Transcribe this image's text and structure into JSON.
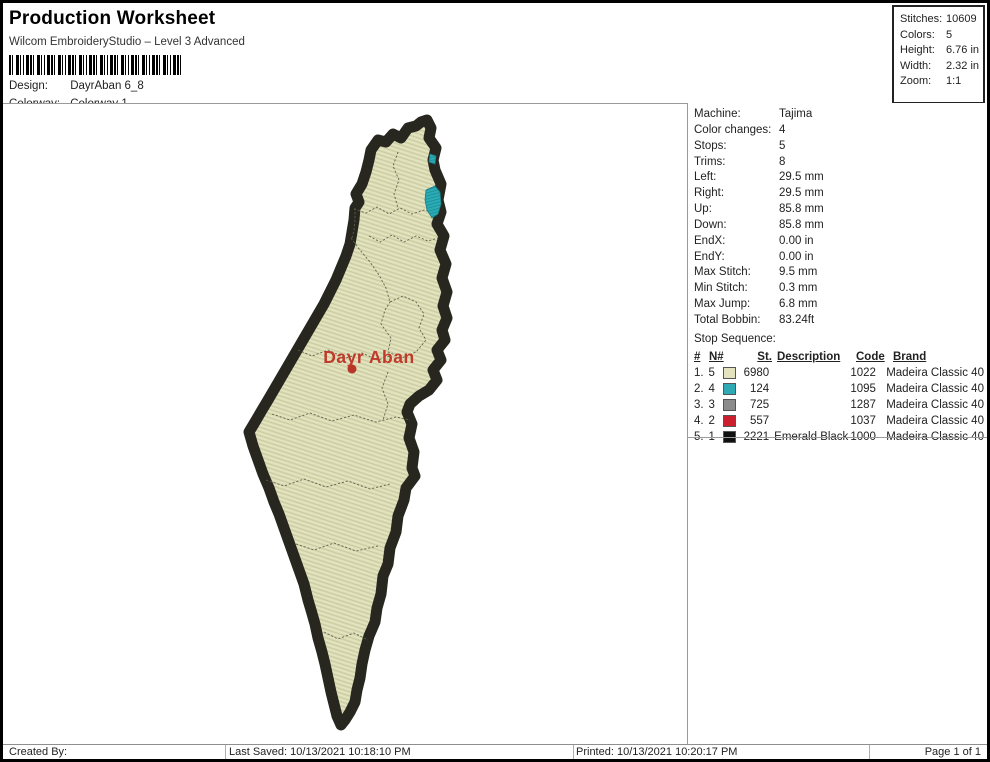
{
  "header": {
    "title": "Production Worksheet",
    "subtitle": "Wilcom EmbroideryStudio – Level 3 Advanced",
    "design_label": "Design:",
    "design_value": "DayrAban 6_8",
    "colorway_label": "Colorway:",
    "colorway_value": "Colorway 1"
  },
  "stats_box": {
    "rows": [
      {
        "label": "Stitches:",
        "value": "10609"
      },
      {
        "label": "Colors:",
        "value": "5"
      },
      {
        "label": "Height:",
        "value": "6.76 in"
      },
      {
        "label": "Width:",
        "value": "2.32 in"
      },
      {
        "label": "Zoom:",
        "value": "1:1"
      }
    ]
  },
  "info_panel": {
    "rows": [
      {
        "label": "Machine:",
        "value": "Tajima"
      },
      {
        "label": "Color changes:",
        "value": "4"
      },
      {
        "label": "Stops:",
        "value": "5"
      },
      {
        "label": "Trims:",
        "value": "8"
      },
      {
        "label": "Left:",
        "value": "29.5 mm"
      },
      {
        "label": "Right:",
        "value": "29.5 mm"
      },
      {
        "label": "Up:",
        "value": "85.8 mm"
      },
      {
        "label": "Down:",
        "value": "85.8 mm"
      },
      {
        "label": "EndX:",
        "value": "0.00 in"
      },
      {
        "label": "EndY:",
        "value": "0.00 in"
      },
      {
        "label": "Max Stitch:",
        "value": "9.5 mm"
      },
      {
        "label": "Min Stitch:",
        "value": "0.3 mm"
      },
      {
        "label": "Max Jump:",
        "value": "6.8 mm"
      },
      {
        "label": "Total Bobbin:",
        "value": "83.24ft"
      }
    ],
    "stop_sequence_label": "Stop Sequence:"
  },
  "stop_table": {
    "headers": {
      "num": "#",
      "n": "N#",
      "st": "St.",
      "description": "Description",
      "code": "Code",
      "brand": "Brand"
    },
    "rows": [
      {
        "num": "1.",
        "n": "5",
        "color": "#e3e3c0",
        "st": "6980",
        "description": "",
        "code": "1022",
        "brand": "Madeira Classic 40"
      },
      {
        "num": "2.",
        "n": "4",
        "color": "#2fa9b4",
        "st": "124",
        "description": "",
        "code": "1095",
        "brand": "Madeira Classic 40"
      },
      {
        "num": "3.",
        "n": "3",
        "color": "#8c8c8c",
        "st": "725",
        "description": "",
        "code": "1287",
        "brand": "Madeira Classic 40"
      },
      {
        "num": "4.",
        "n": "2",
        "color": "#cc1f2d",
        "st": "557",
        "description": "",
        "code": "1037",
        "brand": "Madeira Classic 40"
      },
      {
        "num": "5.",
        "n": "1",
        "color": "#101010",
        "st": "2221",
        "description": "Emerald Black",
        "code": "1000",
        "brand": "Madeira Classic 40"
      }
    ]
  },
  "design_preview": {
    "place_label": "Dayr Aban",
    "fill_color": "#dcddb5",
    "border_color": "#27271f",
    "lake_color": "#2aacb6",
    "label_color": "#c0392b"
  },
  "footer": {
    "created_by_label": "Created By:",
    "last_saved": "Last Saved: 10/13/2021 10:18:10 PM",
    "printed": "Printed: 10/13/2021 10:20:17 PM",
    "page_indicator": "Page 1 of 1"
  }
}
